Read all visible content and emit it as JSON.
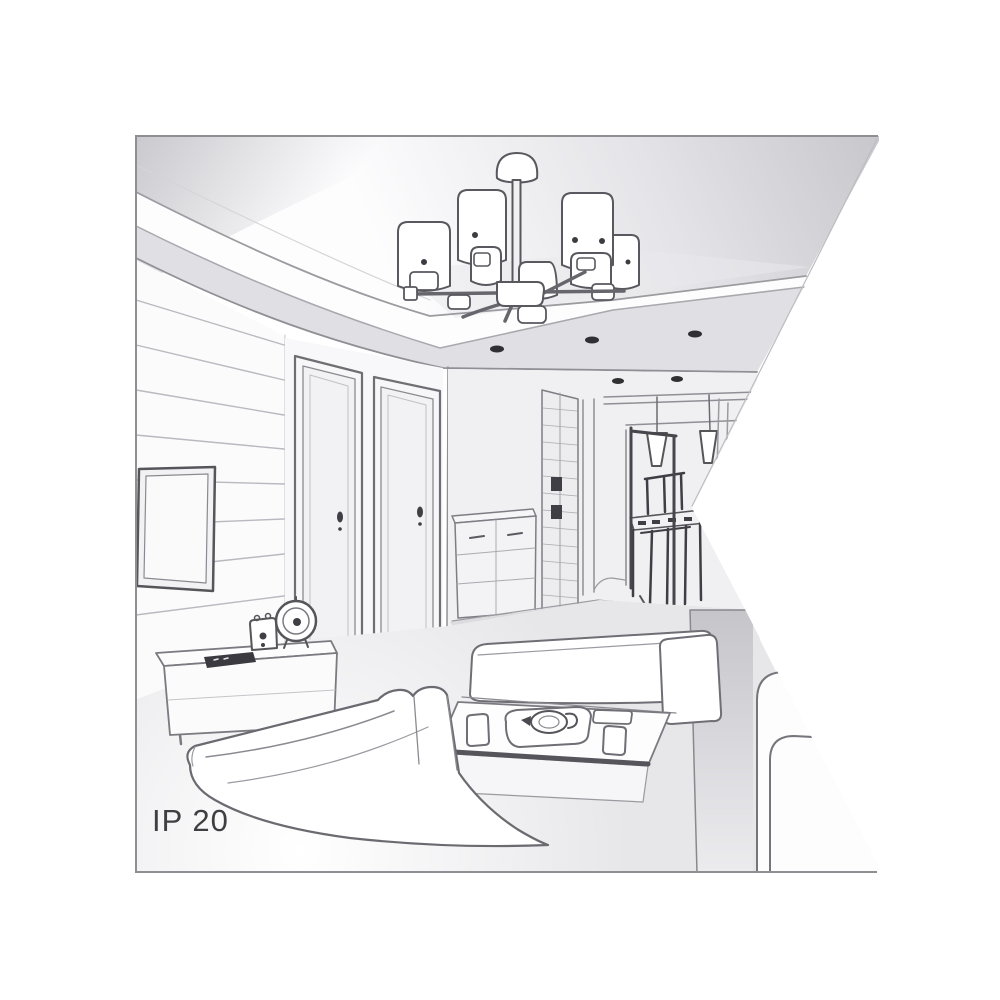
{
  "page": {
    "background": "#ffffff"
  },
  "illustration": {
    "ip_rating": "IP 20",
    "subject": "Pencil-style perspective sketch of a living room interior with a multi-shade ceiling chandelier, tray ceiling with recessed lights, two hallway doors, wall TV, sideboard with clock and speaker, dining nook with pendant lamps, coffee table and white sofas; canvas has a triangular notch on the right edge",
    "colors": {
      "background": "#ffffff",
      "line": "#6e6e74",
      "line_dark": "#3a3a40",
      "ceiling_gray": "#c7c7cc",
      "soffit_gray": "#e0e0e4",
      "floor_gray": "#e7e7ea",
      "sofa_side_gray": "#c5c5ca",
      "border": "#8e8e93",
      "text": "#3f3f42"
    }
  }
}
